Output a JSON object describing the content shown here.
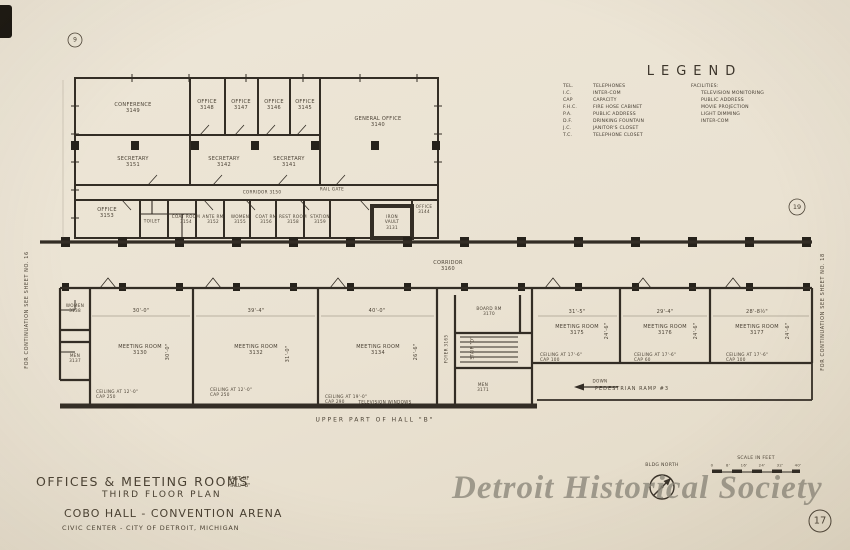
{
  "edge_notes": {
    "left": "FOR CONTINUATION SEE SHEET NO. 16",
    "right": "FOR CONTINUATION SEE SHEET NO. 18"
  },
  "markers": {
    "grid_bubble_top_left": "9",
    "grid_bubble_right": "19",
    "sheet_number": "17"
  },
  "legend": {
    "title": "LEGEND",
    "abbreviations": [
      {
        "abbr": "TEL.",
        "desc": "TELEPHONES"
      },
      {
        "abbr": "I.C.",
        "desc": "INTER-COM"
      },
      {
        "abbr": "CAP",
        "desc": "CAPACITY"
      },
      {
        "abbr": "F.H.C.",
        "desc": "FIRE HOSE CABINET"
      },
      {
        "abbr": "P.A.",
        "desc": "PUBLIC ADDRESS"
      },
      {
        "abbr": "D.F.",
        "desc": "DRINKING FOUNTAIN"
      },
      {
        "abbr": "J.C.",
        "desc": "JANITOR'S CLOSET"
      },
      {
        "abbr": "T.C.",
        "desc": "TELEPHONE CLOSET"
      }
    ],
    "facilities_title": "FACILITIES:",
    "facilities": [
      "TELEVISION MONITORING",
      "PUBLIC ADDRESS",
      "MOVIE PROJECTION",
      "LIGHT DIMMING",
      "INTER-COM"
    ]
  },
  "upper_plan": {
    "rooms": [
      "CONFERENCE\n3149",
      "OFFICE\n3148",
      "OFFICE\n3147",
      "OFFICE\n3146",
      "OFFICE\n3145",
      "GENERAL OFFICE\n3140",
      "SECRETARY\n3151",
      "SECRETARY\n3142",
      "SECRETARY\n3141",
      "OFFICE\n3153",
      "TOILET",
      "COAT ROOM\n3154",
      "ANTE RM\n3152",
      "WOMEN\n3155",
      "COAT RM\n3156",
      "REST ROOM\n3158",
      "STATION\n3159",
      "OFFICE\n3144",
      "IRON\nVAULT\n3131",
      "CORRIDOR 3150",
      "RAIL GATE"
    ]
  },
  "lower_plan": {
    "rooms": [
      "WOMEN\n3138",
      "MEN\n3137",
      "MEETING ROOM\n3130",
      "MEETING ROOM\n3132",
      "MEETING ROOM\n3134",
      "CORRIDOR\n3160",
      "BOARD RM\n3170",
      "STAIR \"D\"",
      "FOYER\n3165",
      "MEN\n3171",
      "MEETING ROOM\n3175",
      "MEETING ROOM\n3176",
      "MEETING ROOM\n3177"
    ],
    "h_dims": [
      "30'-0\"",
      "39'-4\"",
      "40'-0\"",
      "31'-5\"",
      "29'-4\"",
      "28'-8½\""
    ],
    "v_dims": [
      "30'-0\"",
      "31'-0\"",
      "26'-6\"",
      "24'-6\"",
      "24'-6\"",
      "24'-6\""
    ],
    "ceilings": [
      "CEILING AT 12'-0\"\nCAP 250",
      "CEILING AT 12'-0\"\nCAP 250",
      "CEILING AT 19'-0\"\nCAP 290",
      "CEILING AT 17'-6\"\nCAP 100",
      "CEILING AT 17'-6\"\nCAP 60",
      "CEILING AT 17'-6\"\nCAP 100"
    ],
    "notes": {
      "tv_windows": "TELEVISION WINDOWS",
      "hall": "UPPER PART OF HALL \"B\"",
      "ramp": "PEDESTRIAN RAMP #3",
      "down": "DOWN"
    }
  },
  "title_block": {
    "line1": "OFFICES & MEETING ROOMS",
    "east_of": "EAST OF\nHALL \"B\"",
    "line2": "THIRD FLOOR PLAN",
    "line3": "COBO HALL - CONVENTION ARENA",
    "line4": "CIVIC CENTER  -  CITY OF DETROIT, MICHIGAN"
  },
  "compass": {
    "label": "BLDG NORTH"
  },
  "scale_bar": {
    "label": "SCALE IN FEET",
    "ticks": [
      "0",
      "8'",
      "16'",
      "24'",
      "32'",
      "40'"
    ]
  },
  "watermark": "Detroit Historical Society",
  "colors": {
    "paper": "#eae2d2",
    "ink": "#332d25",
    "watermark": "#8d887b"
  }
}
